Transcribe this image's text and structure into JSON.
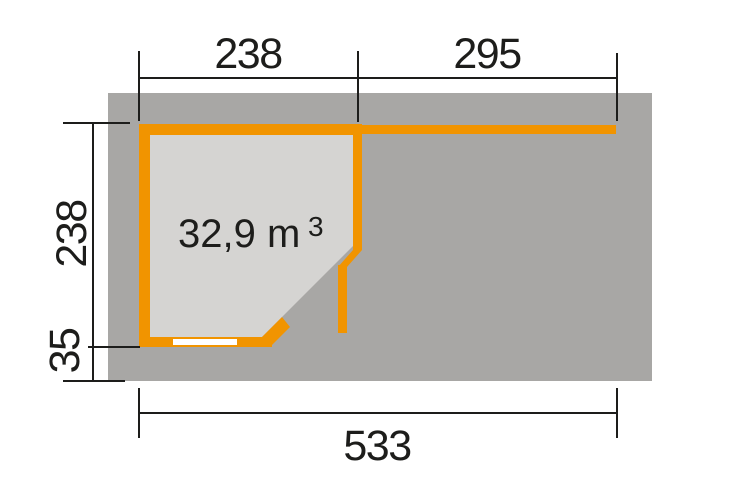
{
  "floor_plan": {
    "volume": {
      "text": "32,9 m",
      "exponent": "3"
    },
    "dimensions": {
      "top_width_left": "238",
      "top_width_right": "295",
      "side_depth": "238",
      "overhang": "35",
      "total_width": "533"
    }
  },
  "colors": {
    "wall-orange": "#F19400",
    "roof-gray": "#A8A7A5",
    "interior-gray": "#D5D4D2",
    "line-black": "#1D1D1B",
    "window-white": "#FFFFFF",
    "background": "#FFFFFF"
  }
}
